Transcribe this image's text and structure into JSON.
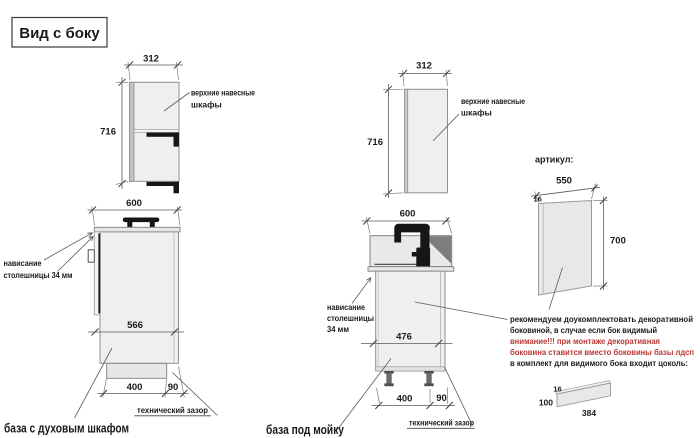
{
  "title": "Вид с боку",
  "colors": {
    "ink": "#1a1a1a",
    "warning_red": "#bb3636",
    "cabinet_fill": "#efefef",
    "line_gray": "#5a5a5a"
  },
  "upper_cabinets": {
    "width": "312",
    "height": "716",
    "label_line1": "верхние навесные",
    "label_line2": "шкафы"
  },
  "oven_base": {
    "width": "600",
    "inner_depth": "566",
    "plinth_depth": "400",
    "gap": "90",
    "overhang_line1": "нависание",
    "overhang_line2": "столешницы 34 мм",
    "tech_gap": "технический зазор",
    "caption": "база с духовым шкафом"
  },
  "sink_base": {
    "width": "600",
    "inner_depth": "476",
    "plinth_depth": "400",
    "gap": "90",
    "overhang_line1": "нависание",
    "overhang_line2": "столешницы",
    "overhang_line3": "34 мм",
    "tech_gap": "технический зазор",
    "caption": "база под мойку"
  },
  "article": {
    "label": "артикул:",
    "side_panel": {
      "width": "550",
      "thickness": "16",
      "height": "700"
    },
    "note_line1": "рекомендуем доукомплектовать декоративной",
    "note_line2": "боковиной, в случае если бок видимый",
    "warn_line1": "внимание!!! при монтаже декоративная",
    "warn_line2": "боковина ставится вместо боковины базы лдсп",
    "note_line3": "в комплект для видимого бока входит цоколь:",
    "plinth": {
      "thickness": "16",
      "height": "100",
      "length": "384"
    }
  }
}
